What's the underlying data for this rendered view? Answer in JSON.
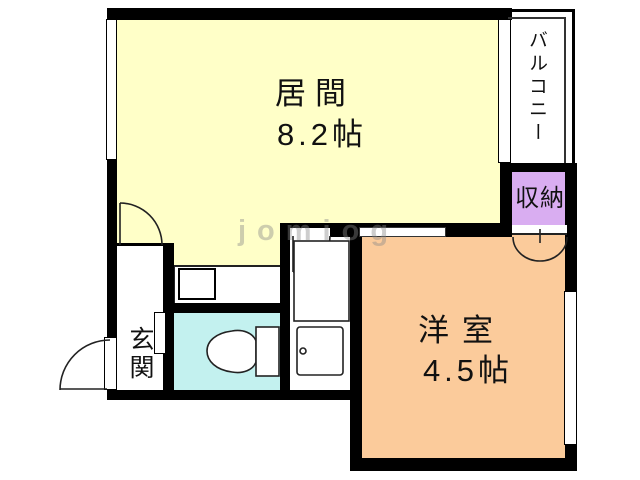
{
  "floorplan": {
    "watermark": "jomiog",
    "rooms": {
      "living": {
        "name": "居間",
        "size": "8.2帖"
      },
      "western": {
        "name": "洋室",
        "size": "4.5帖"
      },
      "storage": {
        "label": "収納"
      },
      "balcony": {
        "label": "バルコニー"
      },
      "entrance": {
        "label": "玄関"
      }
    },
    "colors": {
      "living_floor": "#ffffc8",
      "western_floor": "#fbcb9b",
      "storage_floor": "#d9adf1",
      "toilet_floor": "#c3f1ef",
      "wall": "#000000",
      "background": "#ffffff"
    }
  }
}
